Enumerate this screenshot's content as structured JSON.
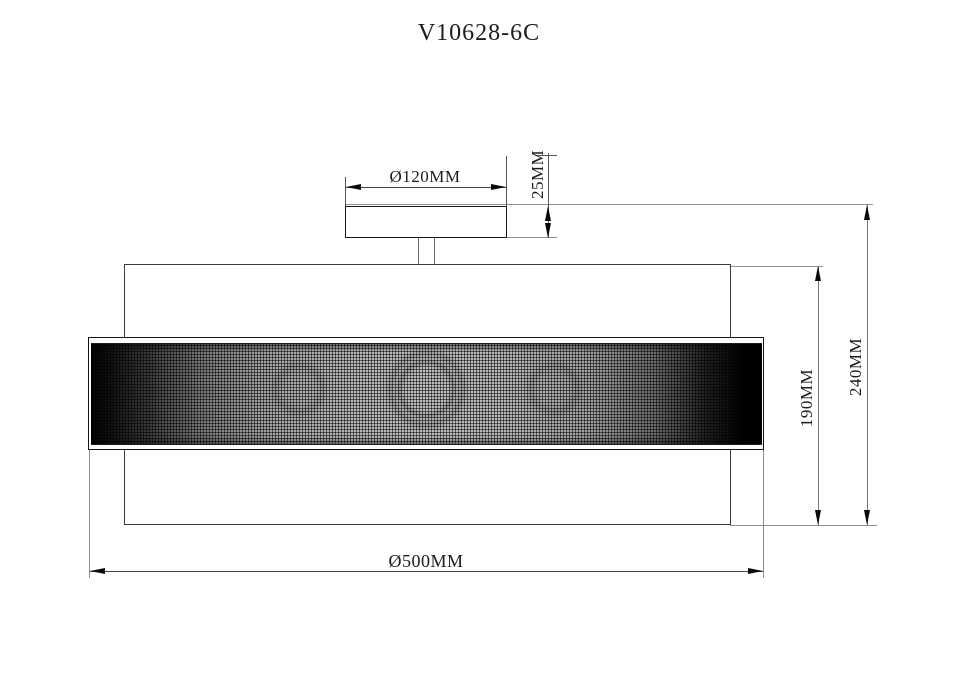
{
  "title": "V10628-6C",
  "dimensions": {
    "canopy_diameter": {
      "label": "Ø120MM"
    },
    "canopy_height": {
      "label": "25MM"
    },
    "drum_height": {
      "label": "190MM"
    },
    "total_height": {
      "label": "240MM"
    },
    "shade_diameter": {
      "label": "Ø500MM"
    }
  },
  "colors": {
    "background": "#ffffff",
    "object_line": "#1a1a1a",
    "dimension_line": "#555555",
    "reference_line": "#8f8f8f",
    "arrow": "#0a0a0a",
    "text": "#1c1c1c",
    "mesh_base": "#b0b0b0"
  }
}
